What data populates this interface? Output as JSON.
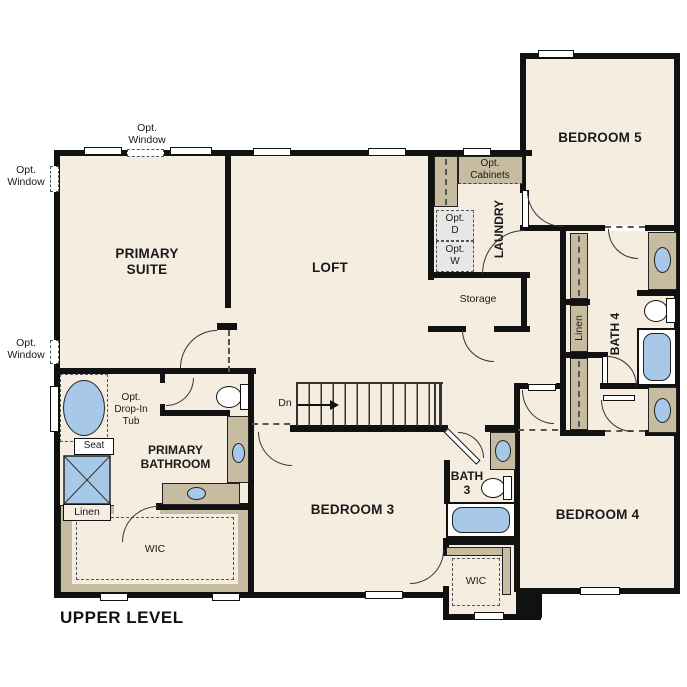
{
  "plan": {
    "title": "UPPER LEVEL",
    "rooms": {
      "primary_suite": "PRIMARY\nSUITE",
      "loft": "LOFT",
      "bedroom5": "BEDROOM 5",
      "bedroom3": "BEDROOM 3",
      "bedroom4": "BEDROOM 4",
      "primary_bathroom": "PRIMARY\nBATHROOM",
      "bath3": "BATH\n3",
      "bath4": "BATH 4",
      "laundry": "LAUNDRY",
      "storage": "Storage",
      "wic_primary": "WIC",
      "wic_bedroom3": "WIC",
      "linen_hall": "Linen",
      "linen_primary": "Linen"
    },
    "annotations": {
      "opt_window_top": "Opt.\nWindow",
      "opt_window_left_upper": "Opt.\nWindow",
      "opt_window_left_lower": "Opt.\nWindow",
      "opt_cabinets": "Opt.\nCabinets",
      "opt_dryer": "Opt.\nD",
      "opt_washer": "Opt.\nW",
      "opt_drop_in_tub": "Opt.\nDrop-In\nTub",
      "seat": "Seat",
      "stairs_down": "Dn"
    },
    "colors": {
      "wall": "#111111",
      "floor": "#f5eee0",
      "cabinet": "#c7bba0",
      "fixture": "#a8c8e8"
    }
  }
}
